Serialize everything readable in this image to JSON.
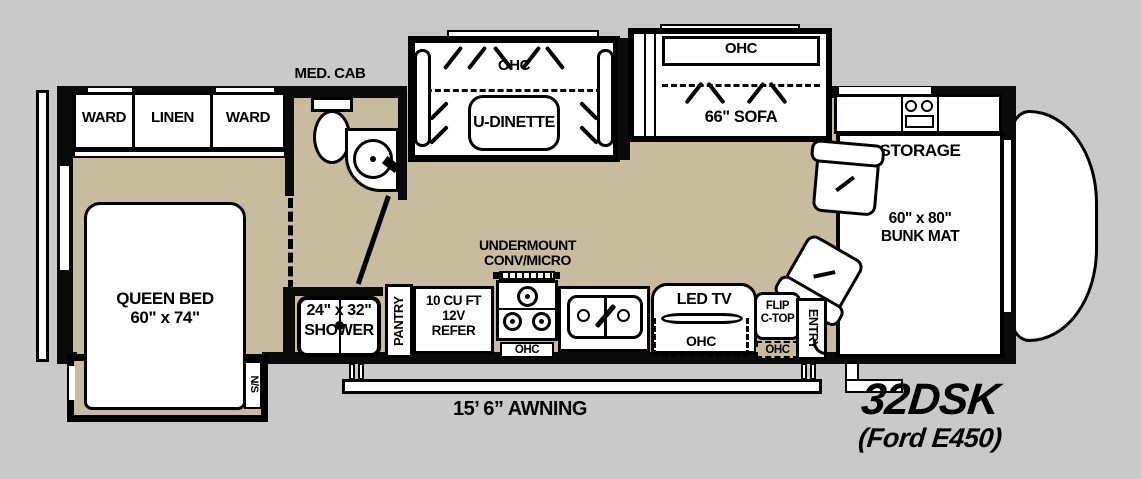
{
  "model": {
    "name": "32DSK",
    "chassis": "(Ford E450)"
  },
  "awning": {
    "label": "15’ 6” AWNING"
  },
  "rear_bedroom": {
    "ward_left": "WARD",
    "linen": "LINEN",
    "ward_right": "WARD",
    "queen_bed_line1": "QUEEN BED",
    "queen_bed_line2": "60\" x 74\"",
    "nightstand": "N/S"
  },
  "bathroom": {
    "med_cab": "MED. CAB",
    "shower_size": "24\" x 32\"",
    "shower": "SHOWER"
  },
  "dinette": {
    "ohc": "OHC",
    "label": "U-DINETTE"
  },
  "sofa": {
    "ohc": "OHC",
    "label": "66\" SOFA"
  },
  "kitchen": {
    "pantry": "PANTRY",
    "refer_line1": "10 CU FT",
    "refer_line2": "12V",
    "refer_line3": "REFER",
    "undermount_line1": "UNDERMOUNT",
    "undermount_line2": "CONV/MICRO",
    "stove_ohc": "OHC",
    "led_tv": "LED TV",
    "tv_ohc": "OHC",
    "flip_line1": "FLIP",
    "flip_line2": "C-TOP",
    "flip_ohc": "OHC"
  },
  "entry": {
    "label": "ENTRY"
  },
  "front": {
    "storage": "STORAGE",
    "bunk_line1": "60\" x 80\"",
    "bunk_line2": "BUNK MAT"
  },
  "colors": {
    "background": "#c9c9c9",
    "floor": "#c8bc9e",
    "line": "#0a0a0a",
    "fixture": "#ffffff"
  }
}
